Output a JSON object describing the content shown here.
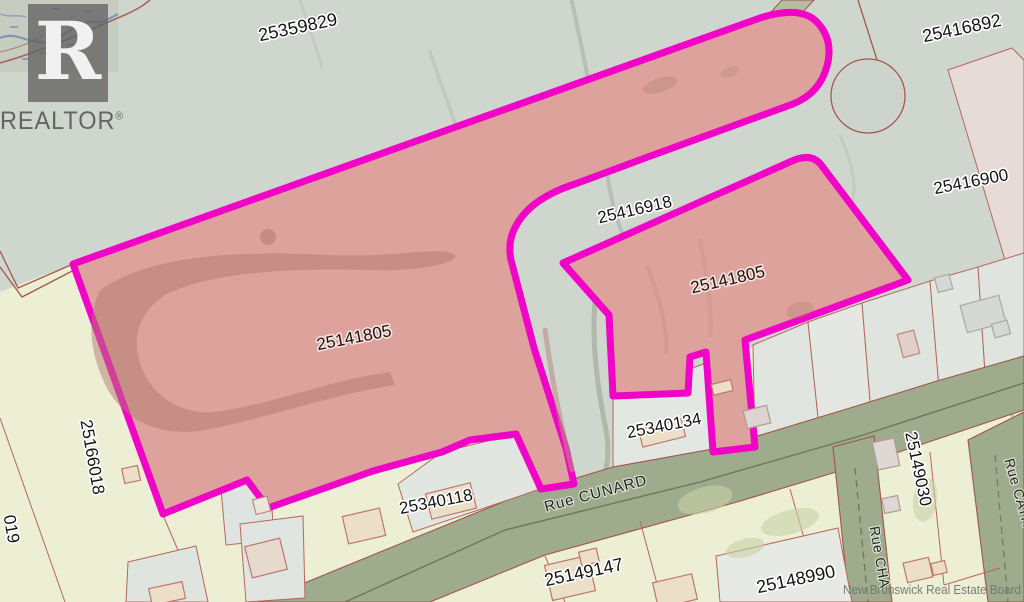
{
  "branding": {
    "logo_letter": "R",
    "logo_text": "REALTOR",
    "registered_mark": "®"
  },
  "watermark": {
    "text": "New Brunswick Real Estate Board"
  },
  "map": {
    "subject_pid": "25141805",
    "parcel_labels": {
      "top": "25359829",
      "top_right": "25416892",
      "right": "25416900",
      "corridor": "25416918",
      "subject_left": "25141805",
      "subject_right": "25141805",
      "west_vertical": "25166018",
      "west_edge_partial": "019",
      "mid": "25340134",
      "mid_west": "25340118",
      "south_west": "25149147",
      "south_mid": "25148990",
      "east_vertical": "25149030"
    },
    "street_labels": {
      "cunard": "Rue CUNARD",
      "champlain_partial": "Rue CHA",
      "catherine_partial": "Rue CATH"
    },
    "colors": {
      "highlight_outline": "#f103c7",
      "subject_fill": "#dca29b",
      "road_fill": "#9fab8d",
      "upper_area": "#cfd6ce",
      "lower_area": "#ecefd4",
      "parcel_line": "#b4685c"
    }
  }
}
